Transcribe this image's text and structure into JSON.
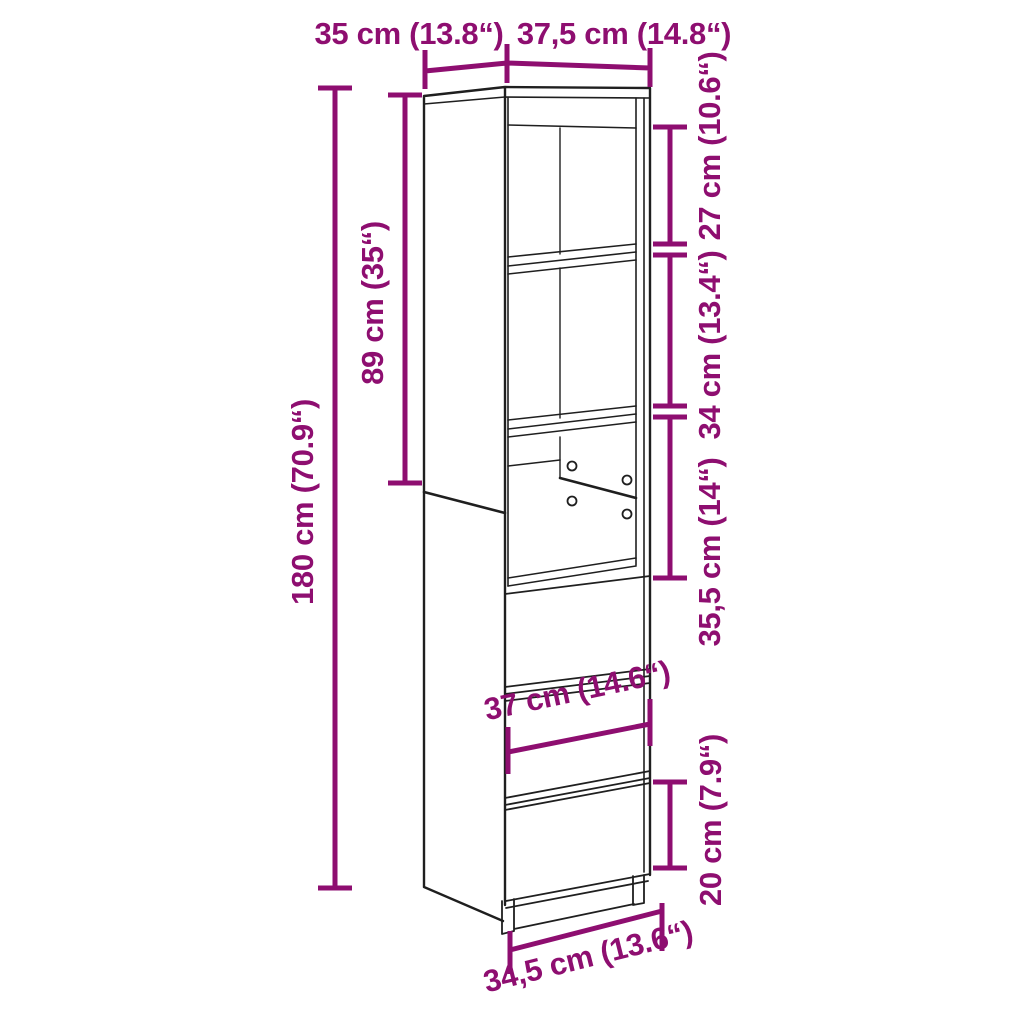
{
  "figure": {
    "kind": "product-dimension-diagram",
    "subject": "tall highboard cabinet with open shelves and drawers, line drawing in perspective",
    "background_color": "#ffffff",
    "accent_color": "#8E0E70",
    "line_color": "#1f1f1f"
  },
  "dims": {
    "depth_top": "35 cm (13.8“)",
    "width_top": "37,5 cm (14.8“)",
    "upper_section_height": "89 cm (35“)",
    "total_height": "180 cm (70.9“)",
    "compartment_1_height": "27 cm (10.6“)",
    "compartment_2_height": "34 cm (13.4“)",
    "compartment_3_height": "35,5 cm (14“)",
    "inner_width": "37 cm (14.6“)",
    "drawer_front_height": "20 cm (7.9“)",
    "base_width": "34,5 cm (13.6“)"
  }
}
